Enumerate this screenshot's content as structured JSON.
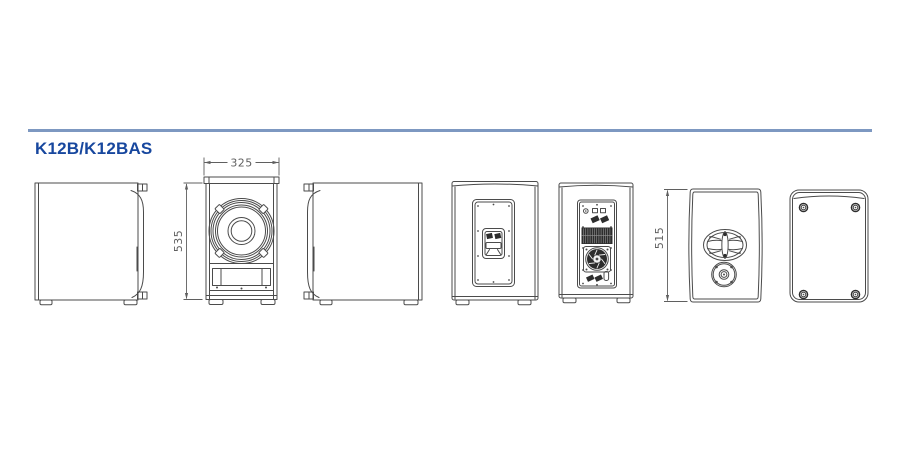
{
  "title": "K12B/K12BAS",
  "colors": {
    "rule_blue": "#7d98c1",
    "title_blue": "#17479e",
    "line_gray": "#4b4b4b",
    "dim_gray": "#5f5f5f",
    "dark_fill": "#2d2d2d"
  },
  "drawing": {
    "dimensions": {
      "front_width": "325",
      "front_height": "535",
      "side_height": "515"
    },
    "views": [
      {
        "name": "side-view-left"
      },
      {
        "name": "front-view"
      },
      {
        "name": "side-view-right"
      },
      {
        "name": "handle-side-view"
      },
      {
        "name": "rear-amplifier-view"
      },
      {
        "name": "bottom-view-pole-mount"
      },
      {
        "name": "top-view"
      }
    ]
  }
}
